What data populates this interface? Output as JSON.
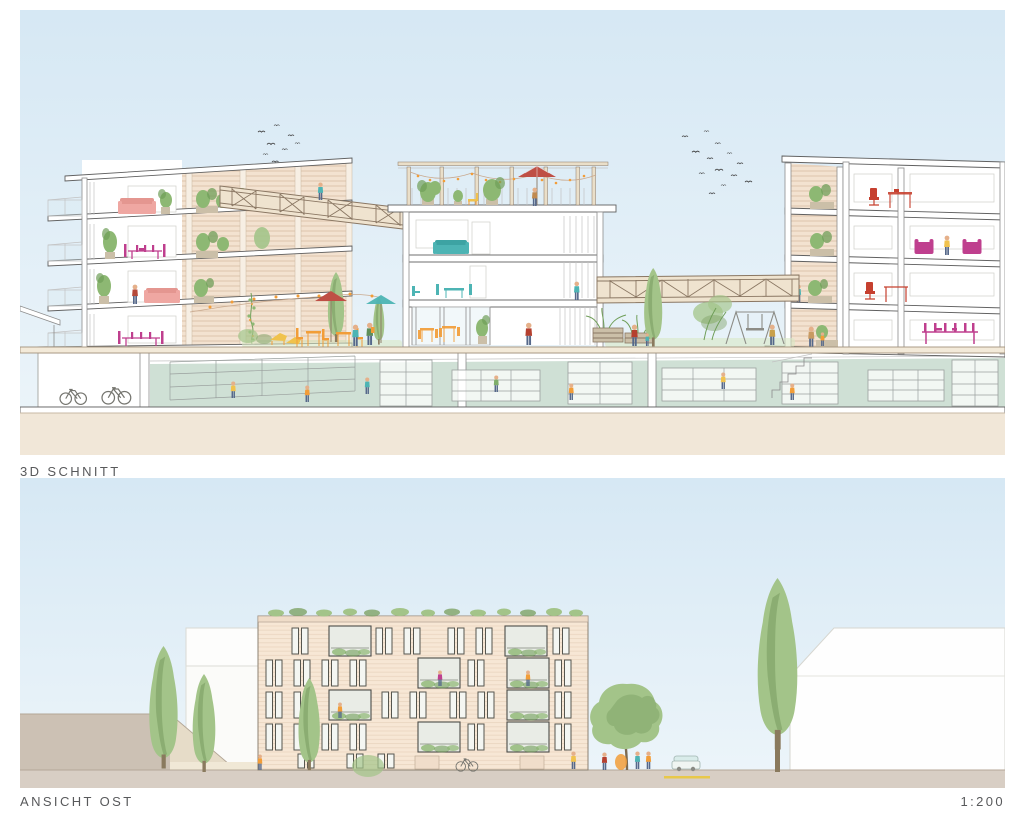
{
  "panels": {
    "section_3d": {
      "caption": "3D SCHNITT"
    },
    "elevation_east": {
      "caption": "ANSICHT OST",
      "scale_label": "1:200"
    }
  },
  "colors": {
    "label_text": "#58595b",
    "sky_top": "#d6e8f4",
    "sky_bottom": "#edf5fa",
    "white_wall": "#ffffff",
    "outline": "#8c8c8c",
    "outline_dark": "#606060",
    "outline_light": "#c2c2c2",
    "facade_tan": "#f3e2d0",
    "facade_light": "#f7e7d5",
    "facade_stripe": "#d9bfa6",
    "ground_beige": "#f1e7d8",
    "street_gray": "#d8cec4",
    "slope_gray": "#ccc1b4",
    "basement_floor": "#cfe0d5",
    "plant_green": "#8db873",
    "plant_dark": "#6f9e58",
    "tree_green": "#a3c489",
    "tree_dark": "#7ea265",
    "magenta": "#bf3f8e",
    "pink": "#efa7a2",
    "red": "#c6402f",
    "umbrella_red": "#bf4f45",
    "teal": "#4db4b4",
    "orange": "#f29d38",
    "yellow": "#f0c24d",
    "wood": "#efe3cf",
    "wood_line": "#8a7763",
    "skin": "#e5b08a",
    "denim": "#55688a"
  }
}
